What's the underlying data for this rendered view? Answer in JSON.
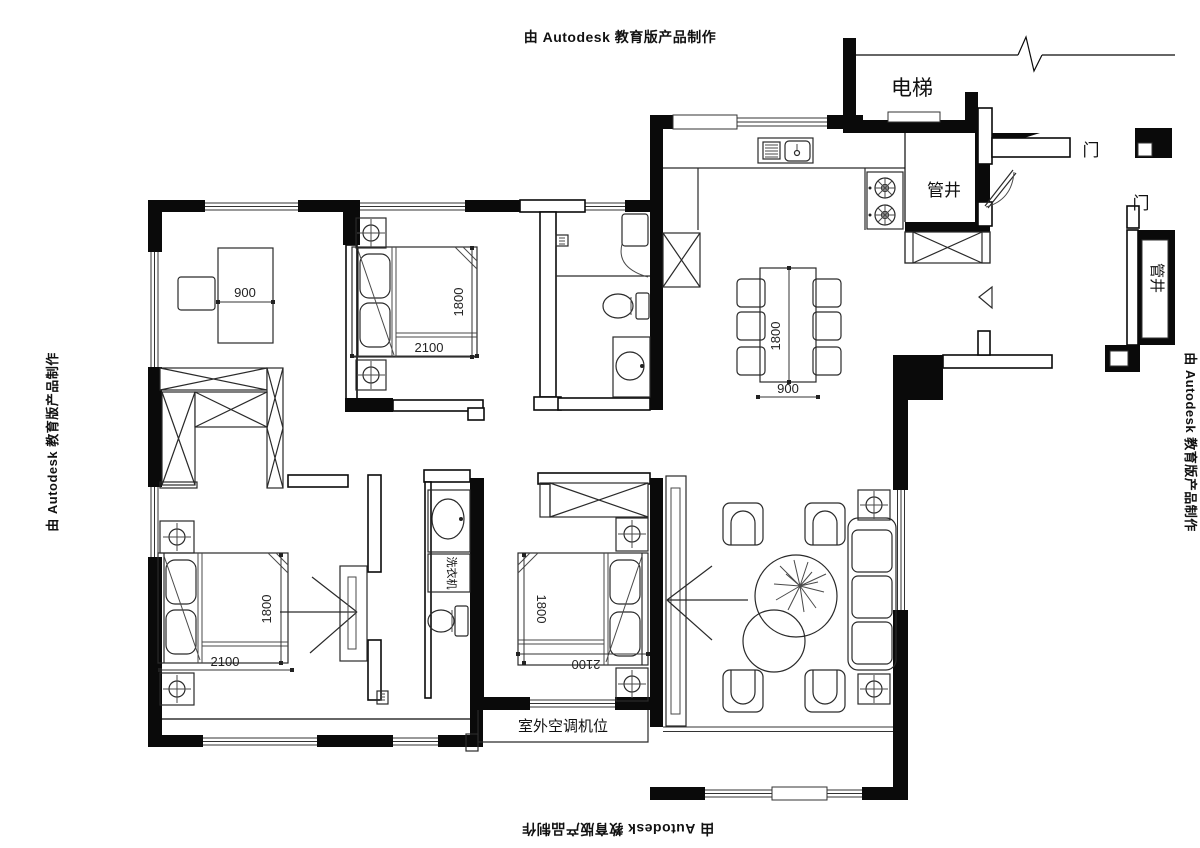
{
  "credits": {
    "top": "由 Autodesk 教育版产品制作",
    "left": "由 Autodesk 教育版产品制作",
    "right": "由 Autodesk 教育版产品制作",
    "bottom": "由 Autodesk 教育版产品制作"
  },
  "labels": {
    "elevator": "电梯",
    "pipe_shaft_top": "管井",
    "pipe_shaft_right": "管井",
    "door_entry": "门",
    "door_right": "门",
    "washing_machine": "洗衣机",
    "outdoor_ac_unit": "室外空调机位"
  },
  "dims": {
    "study_desk": "900",
    "bed_top_w": "2100",
    "bed_top_d": "1800",
    "dining_l": "1800",
    "dining_w": "900",
    "bed_left_w": "2100",
    "bed_left_d": "1800",
    "bed_mid_w": "2100",
    "bed_mid_d": "1800"
  },
  "colors": {
    "wall": "#0a0a0a",
    "line": "#2a2a2a",
    "background": "#ffffff"
  }
}
